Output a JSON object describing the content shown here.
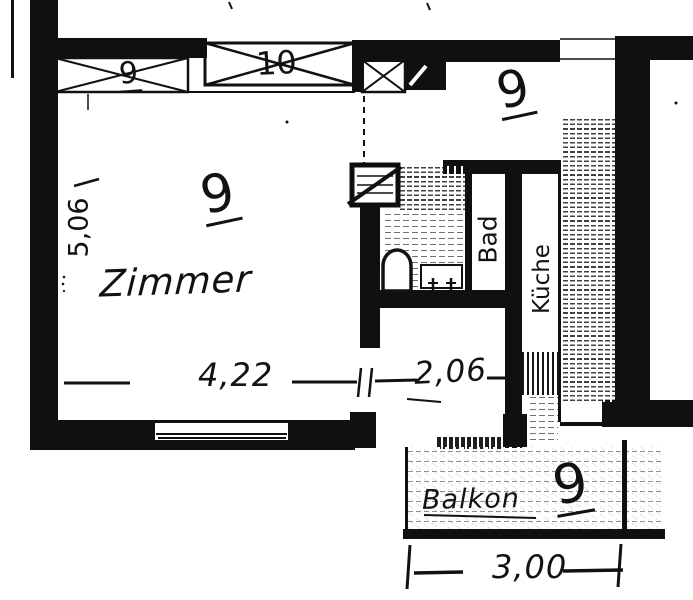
{
  "labels": {
    "zimmer": "Zimmer",
    "bad": "Bad",
    "kueche": "Küche",
    "balkon": "Balkon"
  },
  "numbers": {
    "zimmer_room": "9",
    "hall_room": "9",
    "balkon_room": "9",
    "window_left": "9",
    "window_center": "10"
  },
  "dimensions": {
    "left_height_m": "5,06",
    "zimmer_width_m": "4,22",
    "hall_width_m": "2,06",
    "balkon_width_m": "3,00"
  },
  "colors": {
    "ink": "#101010",
    "paper": "#ffffff"
  }
}
